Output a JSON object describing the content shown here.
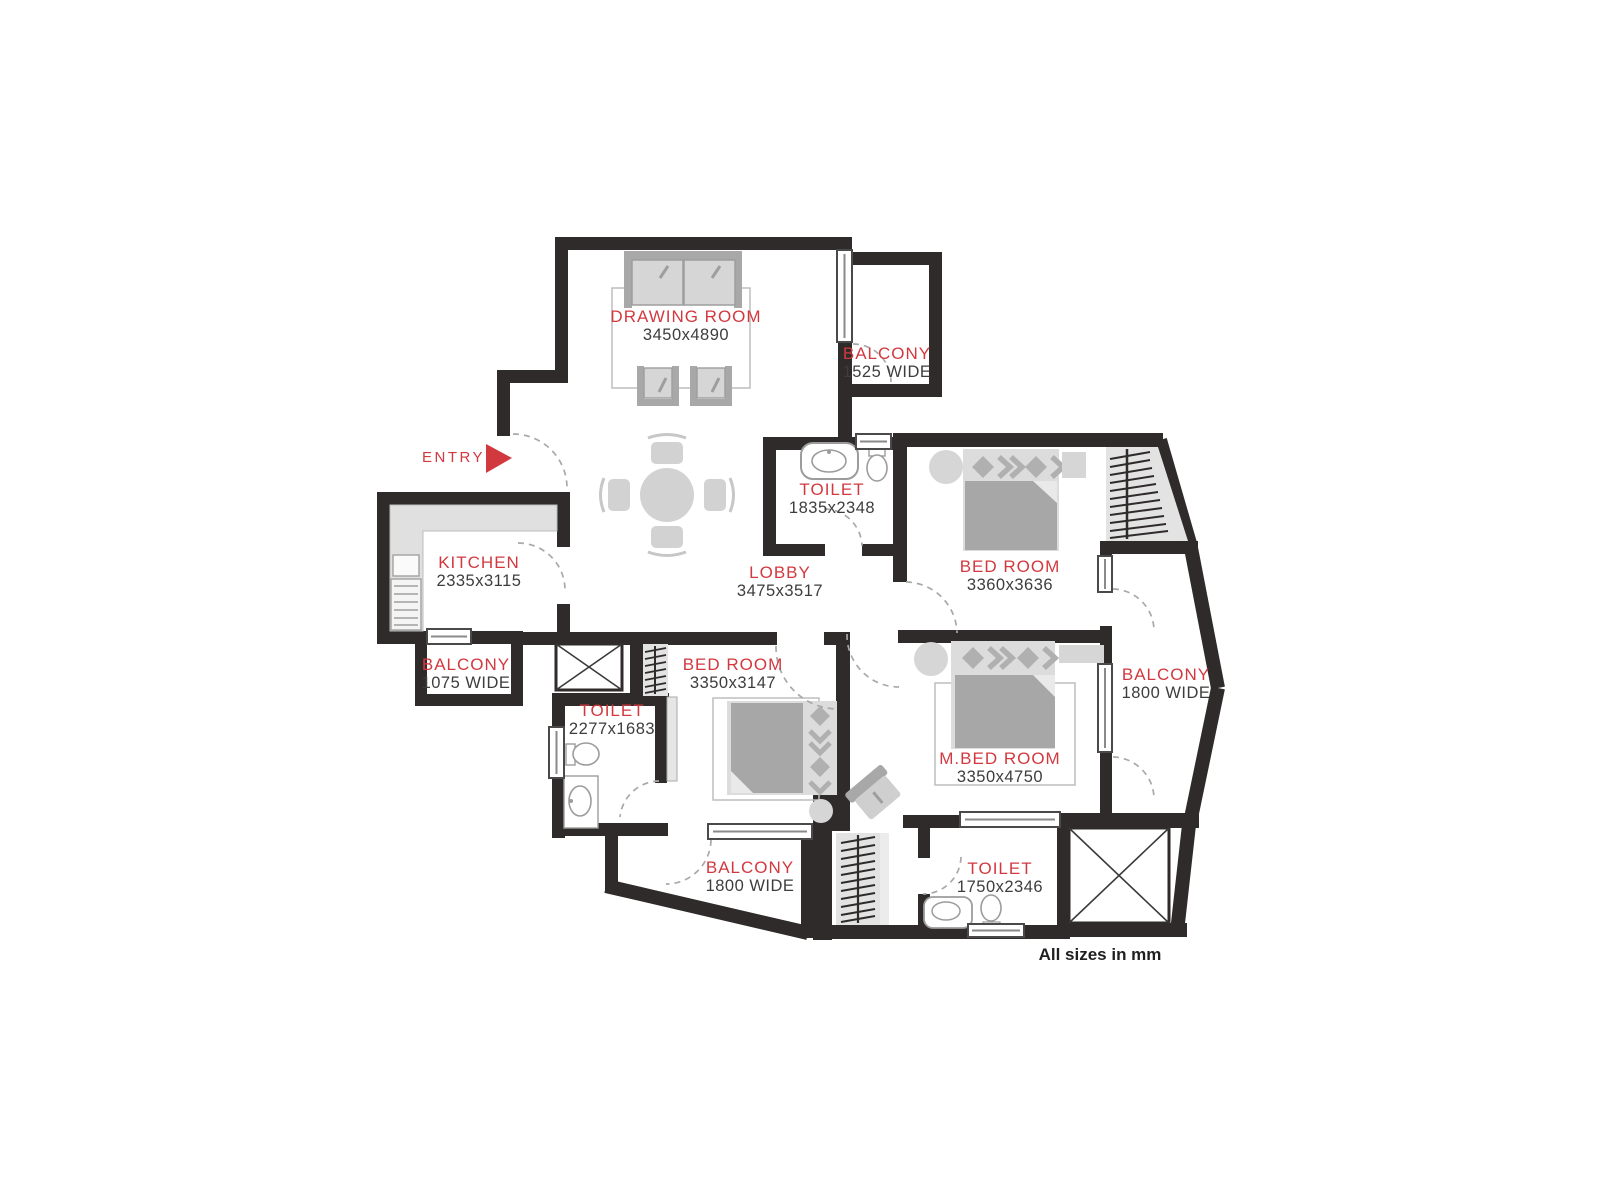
{
  "page": {
    "note": "All sizes in mm"
  },
  "entry": {
    "label": "ENTRY"
  },
  "rooms": [
    {
      "id": "drawing-room",
      "name": "DRAWING ROOM",
      "dims": "3450x4890"
    },
    {
      "id": "balcony-top-right",
      "name": "BALCONY",
      "dims": "1525 WIDE"
    },
    {
      "id": "toilet-common",
      "name": "TOILET",
      "dims": "1835x2348"
    },
    {
      "id": "bed-room-right",
      "name": "BED ROOM",
      "dims": "3360x3636"
    },
    {
      "id": "lobby",
      "name": "LOBBY",
      "dims": "3475x3517"
    },
    {
      "id": "kitchen",
      "name": "KITCHEN",
      "dims": "2335x3115"
    },
    {
      "id": "balcony-kitchen",
      "name": "BALCONY",
      "dims": "1075 WIDE"
    },
    {
      "id": "toilet-left",
      "name": "TOILET",
      "dims": "2277x1683"
    },
    {
      "id": "bed-room-center",
      "name": "BED ROOM",
      "dims": "3350x3147"
    },
    {
      "id": "m-bed-room",
      "name": "M.BED ROOM",
      "dims": "3350x4750"
    },
    {
      "id": "balcony-right",
      "name": "BALCONY",
      "dims": "1800 WIDE"
    },
    {
      "id": "balcony-bottom",
      "name": "BALCONY",
      "dims": "1800 WIDE"
    },
    {
      "id": "toilet-master",
      "name": "TOILET",
      "dims": "1750x2346"
    }
  ],
  "colors": {
    "accent": "#d2393f",
    "wall": "#2f2b2a",
    "dim_text": "#3d3d3d"
  }
}
